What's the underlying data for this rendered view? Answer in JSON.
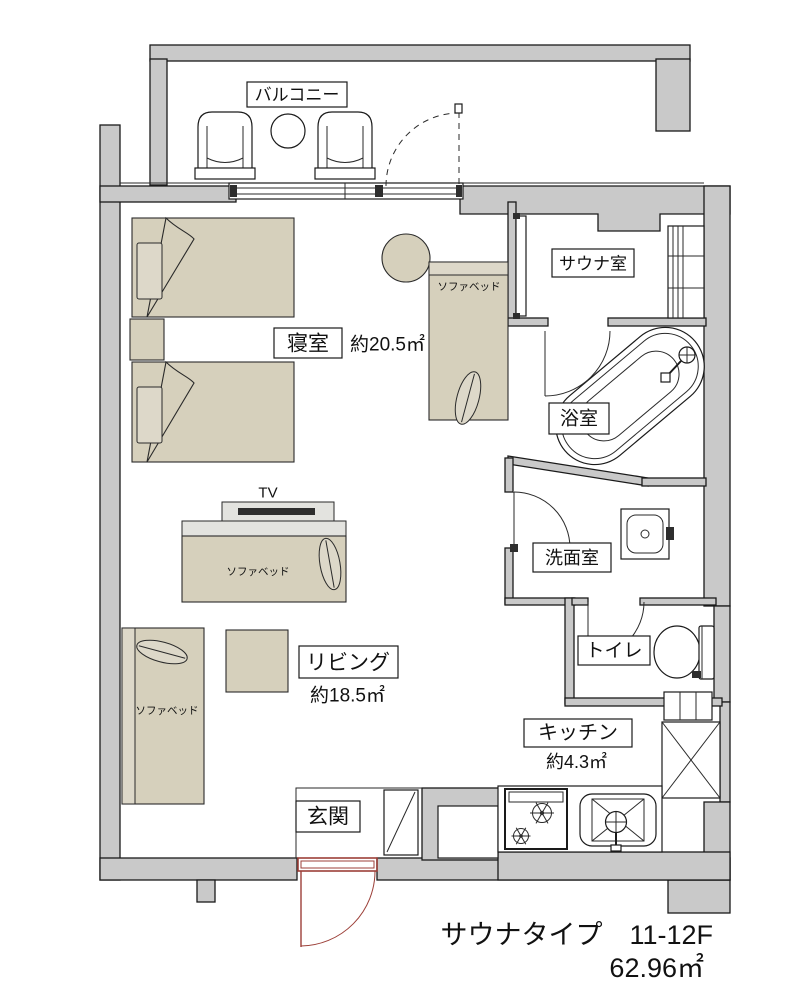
{
  "plan": {
    "rooms": {
      "balcony": "バルコニー",
      "bedroom": "寝室",
      "bedroom_area": "約20.5㎡",
      "sauna": "サウナ室",
      "bath": "浴室",
      "washroom": "洗面室",
      "toilet": "トイレ",
      "living": "リビング",
      "living_area": "約18.5㎡",
      "kitchen": "キッチン",
      "kitchen_area": "約4.3㎡",
      "entrance": "玄関"
    },
    "furniture": {
      "tv": "TV",
      "sofa_bed_right": "ソファベッド",
      "sofa_bed_center": "ソファベッド",
      "sofa_bed_left": "ソファベッド"
    },
    "footer": {
      "line1": "サウナタイプ　11-12F",
      "line2": "62.96㎡"
    },
    "colors": {
      "wall": "#c9c9c9",
      "furniture": "#d6d0bc",
      "entrance_door": "#9c3f38",
      "background": "#ffffff"
    }
  }
}
